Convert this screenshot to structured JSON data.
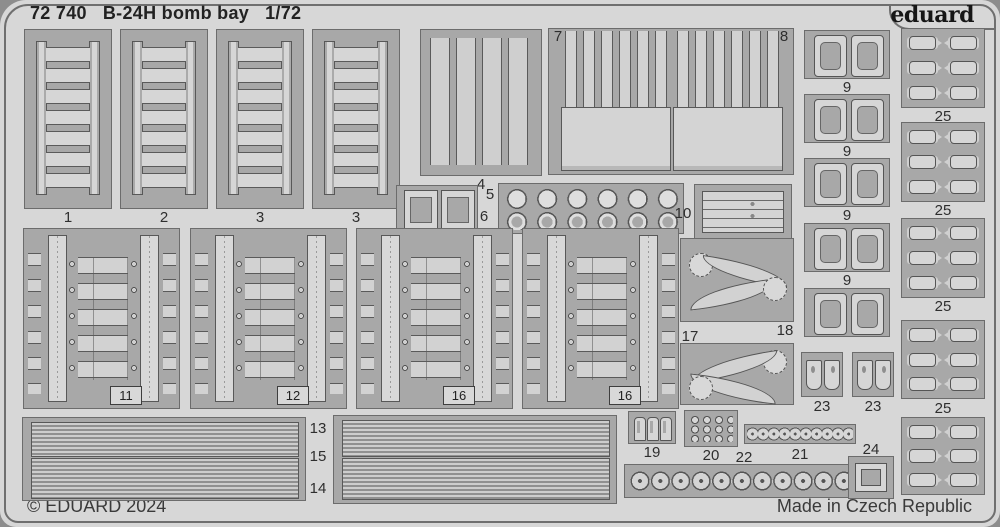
{
  "sheet": {
    "catalog": "72 740",
    "title": "B-24H bomb bay",
    "scale": "1/72",
    "brand": "eduard",
    "copyright": "© EDUARD 2024",
    "made_in": "Made in Czech Republic"
  },
  "colors": {
    "sheet_bg": "#d7d7d7",
    "panel_bg": "#a8a8a8",
    "part_fill": "#d6d6d6",
    "outline": "#585858",
    "text": "#2e2e2e",
    "outer_bg": "#8d8d8d"
  },
  "labels": {
    "l1": "1",
    "l2": "2",
    "l3a": "3",
    "l3b": "3",
    "l4": "4",
    "l5": "5",
    "l6": "6",
    "l7": "7",
    "l8": "8",
    "l9": [
      "9",
      "9",
      "9",
      "9"
    ],
    "l10": "10",
    "l11": "11",
    "l12": "12",
    "l13": "13",
    "l14": "14",
    "l15": "15",
    "l16a": "16",
    "l16b": "16",
    "l17": "17",
    "l18": "18",
    "l19": "19",
    "l20": "20",
    "l21": "21",
    "l22": "22",
    "l23a": "23",
    "l23b": "23",
    "l24": "24",
    "l25": [
      "25",
      "25",
      "25",
      "25"
    ]
  }
}
